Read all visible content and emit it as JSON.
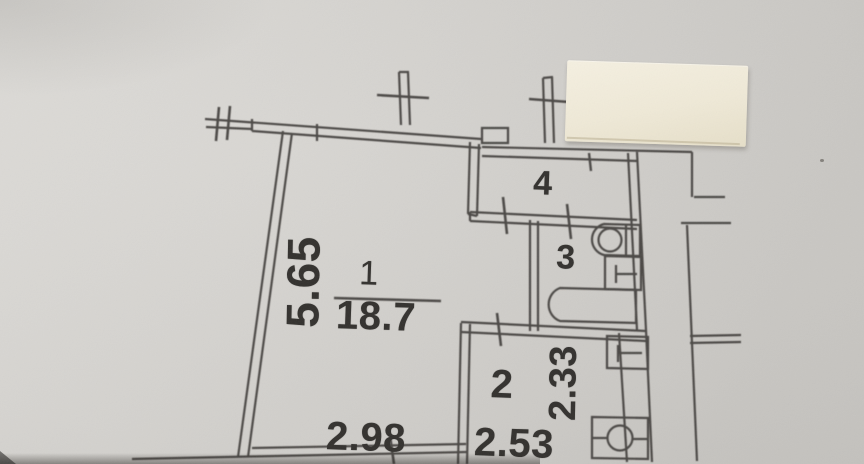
{
  "colors": {
    "paper": "#d6d4d0",
    "ink": "#3b3936",
    "sticker": "#efe9d7",
    "text": "#33312e"
  },
  "rooms": [
    {
      "number": "1",
      "area": "18.7"
    },
    {
      "number": "2"
    },
    {
      "number": "3"
    },
    {
      "number": "4"
    }
  ],
  "dimensions": {
    "room1_height": "5.65",
    "room1_width": "2.98",
    "room2_height": "2.33",
    "room2_width": "2.53"
  },
  "fixtures": [
    "washbasin-icon",
    "toilet-icon",
    "bathtub-icon",
    "appliance-icon",
    "stove-icon"
  ],
  "sticker": {
    "text": ""
  }
}
